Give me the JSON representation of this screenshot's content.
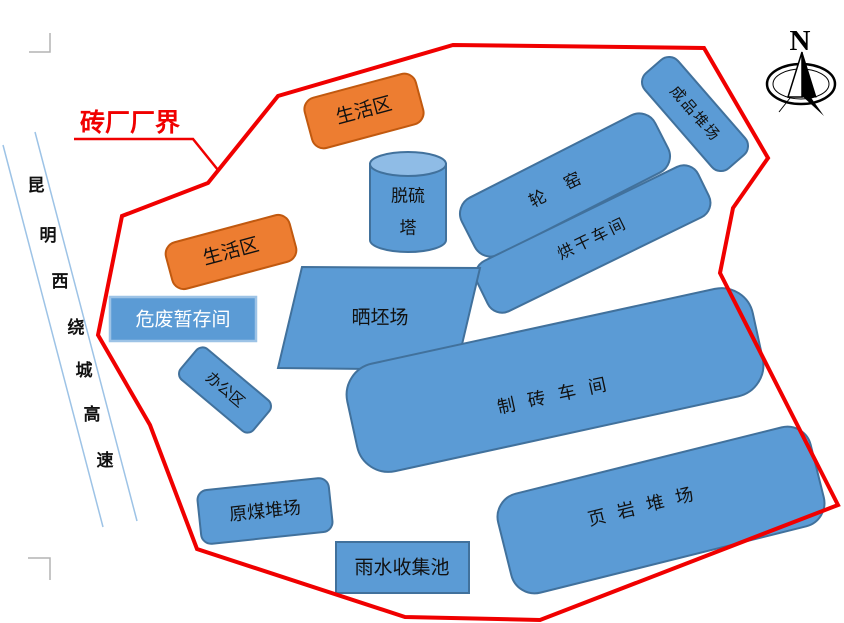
{
  "title": "砖厂厂界",
  "compass": {
    "north_label": "N"
  },
  "road": {
    "name": "昆明西绕城高速",
    "chars": [
      "昆",
      "明",
      "西",
      "绕",
      "城",
      "高",
      "速"
    ]
  },
  "areas": {
    "living_area_top": {
      "label": "生活区"
    },
    "living_area_left": {
      "label": "生活区"
    },
    "desulfurization_tower": {
      "label_line1": "脱硫",
      "label_line2": "塔"
    },
    "ring_kiln": {
      "label": "轮窑"
    },
    "drying_workshop": {
      "label": "烘干车间"
    },
    "finished_product_yard": {
      "label": "成品堆场"
    },
    "hazardous_waste_storage": {
      "label": "危废暂存间"
    },
    "brick_drying_field": {
      "label": "晒坯场"
    },
    "office_area": {
      "label": "办公区"
    },
    "brick_making_workshop": {
      "label": "制砖车间"
    },
    "shale_yard": {
      "label": "页岩堆场"
    },
    "raw_coal_yard": {
      "label": "原煤堆场"
    },
    "rainwater_pool": {
      "label": "雨水收集池"
    }
  },
  "colors": {
    "shape_blue_fill": "#5b9bd5",
    "shape_blue_stroke": "#41719c",
    "cylinder_top_fill": "#8fbce6",
    "shape_orange_fill": "#ed7d31",
    "shape_orange_stroke": "#c1590f",
    "boundary_red": "#f00000",
    "road_line_blue": "#9dc3e6",
    "label_black": "#111111",
    "label_white": "#ffffff"
  }
}
